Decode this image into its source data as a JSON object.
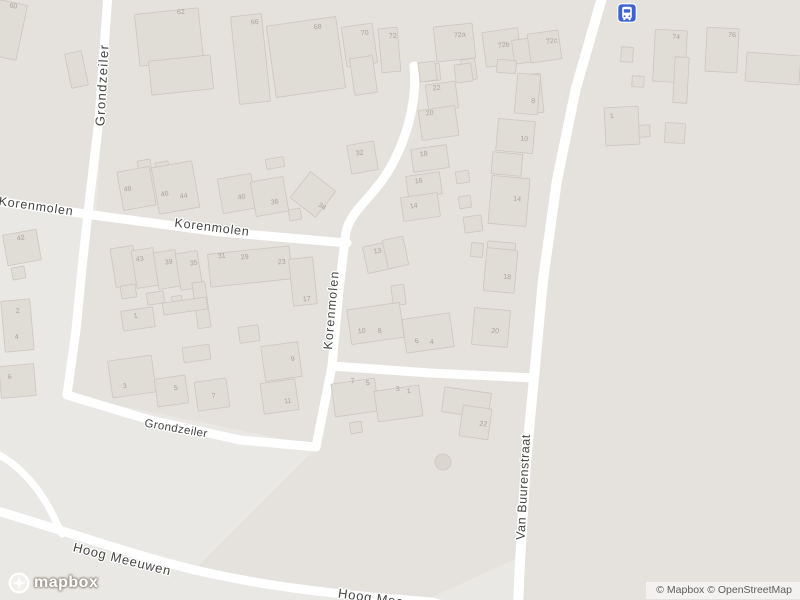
{
  "map": {
    "colors": {
      "background": "#eae8e4",
      "block": "#e5e2dd",
      "building_fill": "#e0dcd6",
      "building_stroke": "#ccc6be",
      "road": "#ffffff",
      "house_number": "#a9a39a",
      "street_label": "#454543",
      "label_halo": "#ffffff",
      "bus_icon_bg": "#3e62d0",
      "tree_fill": "#dbd7d0",
      "tree_stroke": "#ccc7bf"
    },
    "landuse": [
      {
        "points": "92,218 344,246 332,368 316,446 68,395 83,260"
      },
      {
        "points": "112,0 600,0 556,185 534,378 334,369 346,242 96,212 102,128"
      },
      {
        "points": "604,0 800,0 800,600 520,600 526,462 542,282 574,92"
      },
      {
        "points": "334,371 531,379 522,556 428,599 299,588 196,568 318,446"
      },
      {
        "points": "0,0 104,0 95,130 86,212 0,202"
      }
    ],
    "roads": [
      {
        "d": "M 108,-6 L 99,120 L 90,195 L 83,258 L 76,330 L 67,395",
        "w": 9
      },
      {
        "d": "M 67,395 L 150,420 L 240,440 L 316,447",
        "w": 9
      },
      {
        "d": "M -6,201 L 100,216 L 220,232 L 347,243",
        "w": 9
      },
      {
        "d": "M 414,66 C 418,105 404,150 381,182 C 364,204 350,214 346,232 L 339,290 L 332,366 L 316,447",
        "w": 9
      },
      {
        "d": "M 332,366 L 430,373 L 534,378",
        "w": 9
      },
      {
        "d": "M 603,-6 L 576,88 L 557,180 L 543,280 L 534,378 L 526,462 L 520,562 L 518,606",
        "w": 10
      },
      {
        "d": "M -6,510 C 60,529 125,553 195,570 C 268,587 340,595 432,602 L 445,606",
        "w": 9
      },
      {
        "d": "M -6,452 C 24,467 45,496 57,524 L 62,534",
        "w": 7
      }
    ],
    "buildings": [
      [
        -6,
        2,
        28,
        56,
        12
      ],
      [
        68,
        52,
        17,
        35,
        -12
      ],
      [
        12,
        267,
        13,
        12,
        -10
      ],
      [
        5,
        232,
        34,
        31,
        -10
      ],
      [
        3,
        300,
        29,
        51,
        -5
      ],
      [
        0,
        365,
        35,
        32,
        -5
      ],
      [
        137,
        11,
        64,
        52,
        -6
      ],
      [
        150,
        58,
        62,
        34,
        -6
      ],
      [
        235,
        15,
        31,
        88,
        -6
      ],
      [
        271,
        21,
        70,
        72,
        -8
      ],
      [
        344,
        25,
        31,
        40,
        -8
      ],
      [
        352,
        57,
        23,
        37,
        -8
      ],
      [
        380,
        28,
        19,
        44,
        -5
      ],
      [
        435,
        25,
        39,
        35,
        -6
      ],
      [
        423,
        64,
        17,
        17,
        -6
      ],
      [
        484,
        30,
        36,
        35,
        -8
      ],
      [
        513,
        39,
        20,
        24,
        -8
      ],
      [
        462,
        59,
        14,
        21,
        -8
      ],
      [
        529,
        32,
        31,
        29,
        -8
      ],
      [
        527,
        74,
        15,
        39,
        -6
      ],
      [
        654,
        30,
        32,
        52,
        3
      ],
      [
        674,
        57,
        14,
        46,
        3
      ],
      [
        706,
        28,
        32,
        44,
        3
      ],
      [
        746,
        54,
        54,
        29,
        4
      ],
      [
        621,
        47,
        12,
        15,
        3
      ],
      [
        632,
        76,
        12,
        11,
        3
      ],
      [
        605,
        107,
        34,
        38,
        -3
      ],
      [
        639,
        125,
        11,
        12,
        -3
      ],
      [
        665,
        123,
        20,
        20,
        3
      ],
      [
        419,
        62,
        17,
        19,
        -8
      ],
      [
        427,
        83,
        30,
        27,
        -8
      ],
      [
        420,
        108,
        37,
        30,
        -8
      ],
      [
        412,
        147,
        36,
        23,
        -8
      ],
      [
        407,
        174,
        34,
        22,
        -8
      ],
      [
        402,
        195,
        37,
        24,
        -8
      ],
      [
        455,
        64,
        17,
        18,
        -8
      ],
      [
        456,
        171,
        13,
        12,
        -8
      ],
      [
        459,
        196,
        12,
        12,
        -8
      ],
      [
        464,
        216,
        18,
        16,
        -8
      ],
      [
        497,
        60,
        19,
        13,
        5
      ],
      [
        516,
        74,
        23,
        40,
        5
      ],
      [
        497,
        120,
        37,
        32,
        5
      ],
      [
        492,
        153,
        30,
        22,
        5
      ],
      [
        490,
        177,
        38,
        48,
        5
      ],
      [
        487,
        242,
        28,
        17,
        5
      ],
      [
        365,
        244,
        27,
        27,
        -12
      ],
      [
        385,
        238,
        21,
        29,
        -12
      ],
      [
        392,
        285,
        13,
        20,
        -8
      ],
      [
        471,
        243,
        12,
        14,
        5
      ],
      [
        485,
        249,
        31,
        43,
        5
      ],
      [
        473,
        309,
        36,
        37,
        5
      ],
      [
        349,
        306,
        53,
        35,
        -8
      ],
      [
        404,
        316,
        48,
        34,
        -8
      ],
      [
        333,
        381,
        44,
        33,
        -8
      ],
      [
        376,
        388,
        45,
        31,
        -8
      ],
      [
        350,
        422,
        12,
        11,
        -8
      ],
      [
        443,
        390,
        47,
        25,
        8
      ],
      [
        461,
        407,
        29,
        31,
        8
      ],
      [
        138,
        160,
        13,
        12,
        -10
      ],
      [
        156,
        162,
        13,
        12,
        -10
      ],
      [
        266,
        158,
        18,
        10,
        -10
      ],
      [
        120,
        169,
        33,
        39,
        -10
      ],
      [
        155,
        164,
        41,
        47,
        -10
      ],
      [
        220,
        176,
        34,
        35,
        -10
      ],
      [
        253,
        179,
        33,
        35,
        -10
      ],
      [
        297,
        178,
        32,
        33,
        38
      ],
      [
        349,
        143,
        27,
        29,
        -10
      ],
      [
        289,
        209,
        12,
        11,
        -10
      ],
      [
        113,
        247,
        23,
        39,
        -9
      ],
      [
        134,
        249,
        22,
        38,
        -9
      ],
      [
        156,
        251,
        22,
        37,
        -9
      ],
      [
        178,
        252,
        22,
        37,
        -9
      ],
      [
        209,
        250,
        82,
        33,
        -6
      ],
      [
        291,
        258,
        24,
        47,
        -6
      ],
      [
        121,
        285,
        15,
        13,
        -9
      ],
      [
        147,
        292,
        17,
        12,
        -9
      ],
      [
        172,
        296,
        10,
        9,
        -9
      ],
      [
        195,
        282,
        13,
        46,
        -8
      ],
      [
        163,
        300,
        44,
        12,
        -8
      ],
      [
        122,
        309,
        32,
        20,
        -8
      ],
      [
        110,
        358,
        44,
        37,
        -8
      ],
      [
        156,
        377,
        31,
        28,
        -8
      ],
      [
        196,
        380,
        32,
        29,
        -8
      ],
      [
        263,
        344,
        37,
        35,
        -8
      ],
      [
        262,
        381,
        35,
        31,
        -8
      ],
      [
        183,
        346,
        27,
        15,
        -8
      ],
      [
        239,
        326,
        20,
        16,
        -8
      ]
    ],
    "house_numbers": [
      {
        "text": "60",
        "x": 13,
        "y": 8,
        "rot": 10
      },
      {
        "text": "62",
        "x": 181,
        "y": 14,
        "rot": -5
      },
      {
        "text": "66",
        "x": 255,
        "y": 24,
        "rot": -5
      },
      {
        "text": "68",
        "x": 318,
        "y": 29,
        "rot": -8
      },
      {
        "text": "70",
        "x": 365,
        "y": 35,
        "rot": -8
      },
      {
        "text": "72",
        "x": 393,
        "y": 38,
        "rot": -5
      },
      {
        "text": "72a",
        "x": 460,
        "y": 37,
        "rot": -6
      },
      {
        "text": "72b",
        "x": 504,
        "y": 47,
        "rot": -8
      },
      {
        "text": "72c",
        "x": 552,
        "y": 43,
        "rot": -8
      },
      {
        "text": "74",
        "x": 676,
        "y": 39,
        "rot": 3
      },
      {
        "text": "76",
        "x": 732,
        "y": 37,
        "rot": 3
      },
      {
        "text": "1",
        "x": 612,
        "y": 118,
        "rot": -3
      },
      {
        "text": "22",
        "x": 437,
        "y": 90,
        "rot": -8
      },
      {
        "text": "20",
        "x": 430,
        "y": 115,
        "rot": -8
      },
      {
        "text": "18",
        "x": 424,
        "y": 156,
        "rot": -8
      },
      {
        "text": "16",
        "x": 419,
        "y": 183,
        "rot": -8
      },
      {
        "text": "14",
        "x": 414,
        "y": 208,
        "rot": -8
      },
      {
        "text": "8",
        "x": 533,
        "y": 103,
        "rot": 5
      },
      {
        "text": "10",
        "x": 524,
        "y": 141,
        "rot": 5
      },
      {
        "text": "14",
        "x": 517,
        "y": 201,
        "rot": 5
      },
      {
        "text": "48",
        "x": 128,
        "y": 191,
        "rot": -10
      },
      {
        "text": "46",
        "x": 165,
        "y": 196,
        "rot": -10
      },
      {
        "text": "44",
        "x": 184,
        "y": 198,
        "rot": -10
      },
      {
        "text": "40",
        "x": 242,
        "y": 199,
        "rot": -10
      },
      {
        "text": "36",
        "x": 275,
        "y": 204,
        "rot": -10
      },
      {
        "text": "34",
        "x": 321,
        "y": 208,
        "rot": 35
      },
      {
        "text": "32",
        "x": 360,
        "y": 155,
        "rot": -10
      },
      {
        "text": "42",
        "x": 21,
        "y": 240,
        "rot": -10
      },
      {
        "text": "43",
        "x": 140,
        "y": 261,
        "rot": -9
      },
      {
        "text": "39",
        "x": 169,
        "y": 264,
        "rot": -9
      },
      {
        "text": "35",
        "x": 194,
        "y": 265,
        "rot": -9
      },
      {
        "text": "31",
        "x": 222,
        "y": 258,
        "rot": -6
      },
      {
        "text": "29",
        "x": 245,
        "y": 259,
        "rot": -6
      },
      {
        "text": "23",
        "x": 282,
        "y": 264,
        "rot": -6
      },
      {
        "text": "17",
        "x": 307,
        "y": 301,
        "rot": -6
      },
      {
        "text": "2",
        "x": 18,
        "y": 313,
        "rot": -5
      },
      {
        "text": "4",
        "x": 17,
        "y": 339,
        "rot": -5
      },
      {
        "text": "6",
        "x": 10,
        "y": 379,
        "rot": -5
      },
      {
        "text": "1",
        "x": 136,
        "y": 318,
        "rot": -8
      },
      {
        "text": "3",
        "x": 125,
        "y": 388,
        "rot": -8
      },
      {
        "text": "5",
        "x": 176,
        "y": 390,
        "rot": -8
      },
      {
        "text": "7",
        "x": 214,
        "y": 398,
        "rot": -8
      },
      {
        "text": "9",
        "x": 293,
        "y": 361,
        "rot": -8
      },
      {
        "text": "11",
        "x": 288,
        "y": 403,
        "rot": -8
      },
      {
        "text": "13",
        "x": 378,
        "y": 253,
        "rot": -12
      },
      {
        "text": "18",
        "x": 507,
        "y": 279,
        "rot": 5
      },
      {
        "text": "20",
        "x": 495,
        "y": 333,
        "rot": 5
      },
      {
        "text": "10",
        "x": 362,
        "y": 333,
        "rot": -8
      },
      {
        "text": "8",
        "x": 380,
        "y": 333,
        "rot": -8
      },
      {
        "text": "6",
        "x": 417,
        "y": 343,
        "rot": -8
      },
      {
        "text": "4",
        "x": 432,
        "y": 344,
        "rot": -8
      },
      {
        "text": "7",
        "x": 353,
        "y": 383,
        "rot": -8
      },
      {
        "text": "5",
        "x": 368,
        "y": 385,
        "rot": -8
      },
      {
        "text": "3",
        "x": 398,
        "y": 391,
        "rot": -8
      },
      {
        "text": "1",
        "x": 409,
        "y": 393,
        "rot": -8
      },
      {
        "text": "22",
        "x": 483,
        "y": 426,
        "rot": 8
      }
    ],
    "street_labels": [
      {
        "text": "Grondzeiler",
        "x": 103,
        "y": 85,
        "rot": -87,
        "size": 13,
        "ls": 1.4
      },
      {
        "text": "Korenmolen",
        "x": 36,
        "y": 207,
        "rot": 8,
        "size": 12.5,
        "ls": 0.8
      },
      {
        "text": "Korenmolen",
        "x": 212,
        "y": 228,
        "rot": 7,
        "size": 12.5,
        "ls": 0.8
      },
      {
        "text": "Korenmolen",
        "x": 332,
        "y": 310,
        "rot": -85,
        "size": 12.5,
        "ls": 1.2
      },
      {
        "text": "Grondzeiler",
        "x": 176,
        "y": 429,
        "rot": 10,
        "size": 11.5,
        "ls": 0.4
      },
      {
        "text": "Van Buurenstraat",
        "x": 524,
        "y": 487,
        "rot": -87,
        "size": 12.5,
        "ls": 0.6
      },
      {
        "text": "Hoog Meeuwen",
        "x": 122,
        "y": 560,
        "rot": 14,
        "size": 13,
        "ls": 0.8
      },
      {
        "text": "Hoog Meeuwen",
        "x": 388,
        "y": 601,
        "rot": 8,
        "size": 13,
        "ls": 0.8
      }
    ],
    "bus_stop": {
      "x": 617,
      "y": 3,
      "icon": "bus-icon"
    },
    "tree": {
      "x": 443,
      "y": 462,
      "r": 8
    }
  },
  "branding": {
    "logo_text": "mapbox"
  },
  "attribution": {
    "text": "© Mapbox © OpenStreetMap"
  }
}
